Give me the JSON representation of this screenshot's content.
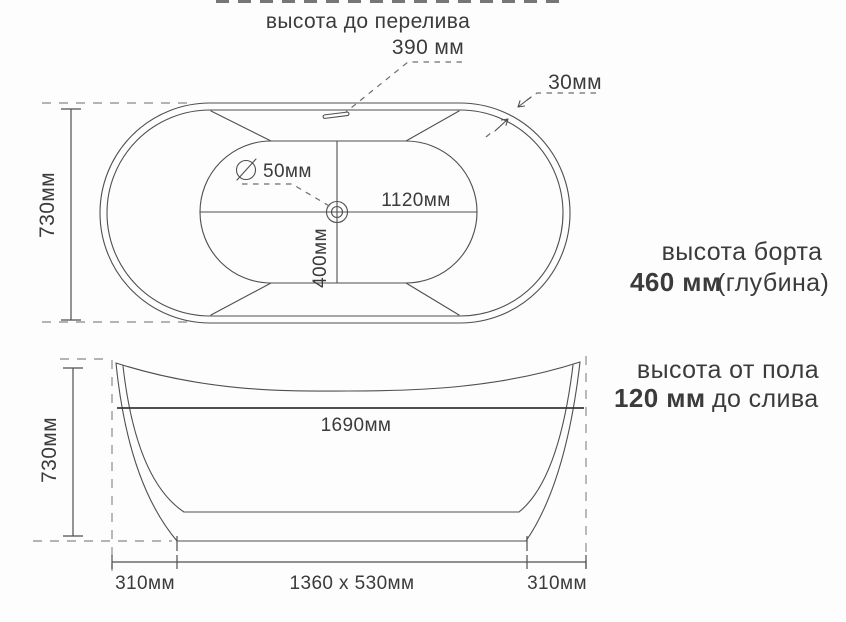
{
  "top_view": {
    "overflow_label": "высота до перелива",
    "overflow_value": "390 мм",
    "wall_thickness": "30мм",
    "drain_diameter": "50мм",
    "inner_length": "1120мм",
    "inner_width": "400мм",
    "overall_width": "730мм"
  },
  "side_view": {
    "overall_height": "730мм",
    "overall_length": "1690мм",
    "base_left_offset": "310мм",
    "base_size": "1360 x 530мм",
    "base_right_offset": "310мм"
  },
  "annotations": {
    "rim_height_label": "высота борта",
    "rim_height_value": "460 мм",
    "rim_height_suffix": "(глубина)",
    "floor_height_label": "высота от пола",
    "floor_height_value": "120 мм",
    "floor_height_suffix": "до слива"
  },
  "colors": {
    "line": "#4f4f4f",
    "dashed_line": "#9c9c9c",
    "leader_line": "#6e6e6e",
    "text": "#3b3b3b",
    "background": "#fdfdfd"
  }
}
